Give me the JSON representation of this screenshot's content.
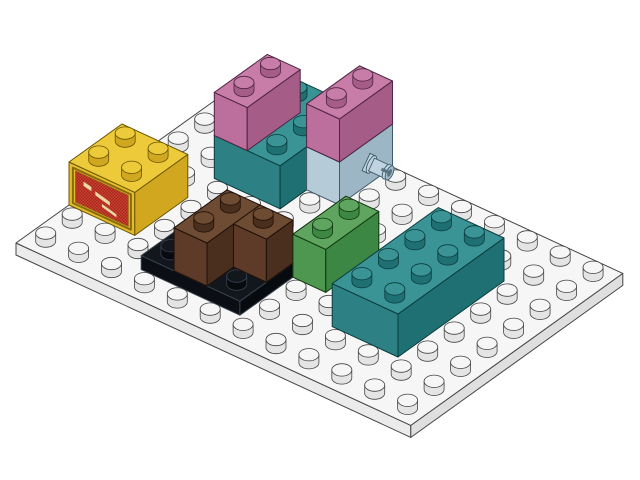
{
  "scene": {
    "type": "isometric-lego-render",
    "background": "#ffffff",
    "baseplate": {
      "name": "white-baseplate-12x8",
      "part": "plate 12 x 8",
      "cols": 12,
      "rows": 8,
      "colors": {
        "top": "#f6f6f6",
        "left": "#ebebeb",
        "right": "#dfdfdf",
        "stud_top": "#f6f6f6",
        "stud_side": "#e4e4e4",
        "edge": "#454545"
      }
    },
    "pieces": [
      {
        "name": "teal-brick-2x3-center",
        "part": "brick 2 x 3 teal",
        "color_name": "teal",
        "level": 0,
        "height": "brick",
        "boxes": [
          {
            "i": 2,
            "j": 5,
            "w": 2,
            "d": 3
          }
        ],
        "colors": {
          "top": "#3a9496",
          "left": "#2d8184",
          "right": "#1f7073",
          "edge": "#0b3b3c"
        }
      },
      {
        "name": "pink-brick-1x2-left",
        "part": "brick 1 x 2 dark pink",
        "color_name": "dark-pink",
        "level": 43,
        "height": "brick",
        "boxes": [
          {
            "i": 2,
            "j": 5,
            "w": 1,
            "d": 2
          }
        ],
        "colors": {
          "top": "#c87ca8",
          "left": "#bc6f9c",
          "right": "#a55d88",
          "edge": "#4e2440"
        }
      },
      {
        "name": "light-blue-brick-1x2-with-pin",
        "part": "brick 1 x 2 with technic pin",
        "color_name": "light-blue-gray",
        "level": 0,
        "height": "brick",
        "boxes": [
          {
            "i": 4,
            "j": 6,
            "w": 1,
            "d": 2
          }
        ],
        "colors": {
          "top": "#c4d6e0",
          "left": "#b5cbd7",
          "right": "#9cb6c5",
          "edge": "#3f5a68"
        },
        "pin": {
          "j_center": 7,
          "attach_height": 24,
          "length": 26,
          "colors": {
            "body": "#bfd4e0",
            "tip": "#a3bccb",
            "slot": "#5a7280",
            "edge": "#3f5a68"
          }
        }
      },
      {
        "name": "pink-brick-1x2-right",
        "part": "brick 1 x 2 dark pink",
        "color_name": "dark-pink",
        "level": 43,
        "height": "brick",
        "boxes": [
          {
            "i": 4,
            "j": 6,
            "w": 1,
            "d": 2
          }
        ],
        "colors": {
          "top": "#c87ca8",
          "left": "#bc6f9c",
          "right": "#a55d88",
          "edge": "#4e2440"
        }
      },
      {
        "name": "yellow-brick-2x2-decorated",
        "part": "brick 2 x 2 with red print",
        "color_name": "yellow",
        "level": 0,
        "height": "brick",
        "boxes": [
          {
            "i": 0,
            "j": 2,
            "w": 2,
            "d": 2
          }
        ],
        "colors": {
          "top": "#ecca3a",
          "left": "#e2bc2a",
          "right": "#d0a71e",
          "edge": "#6b5500"
        },
        "print": {
          "panel_color": "#a5251a",
          "dither_color": "#cf4a35",
          "accent_color": "#ecd7a8",
          "frame_color": "#8a6a10"
        }
      },
      {
        "name": "black-plate-3x2",
        "part": "plate 3 x 2 black",
        "color_name": "black",
        "level": 0,
        "height": "plate",
        "boxes": [
          {
            "i": 3,
            "j": 1,
            "w": 3,
            "d": 2
          }
        ],
        "colors": {
          "top": "#12171e",
          "left": "#0b0f15",
          "right": "#070b10",
          "edge": "#39424c"
        }
      },
      {
        "name": "brown-corner-brick-2x2",
        "part": "brick 2 x 2 corner brown",
        "color_name": "brown",
        "level": 14,
        "height": "brick",
        "boxes": [
          {
            "i": 4,
            "j": 1,
            "w": 1,
            "d": 2
          },
          {
            "i": 5,
            "j": 2,
            "w": 1,
            "d": 1
          }
        ],
        "colors": {
          "top": "#6e4c34",
          "left": "#5d3b28",
          "right": "#4a2e1e",
          "edge": "#1f1008"
        }
      },
      {
        "name": "green-brick-1x2",
        "part": "brick 1 x 2 green",
        "color_name": "green",
        "level": 0,
        "height": "brick",
        "boxes": [
          {
            "i": 6,
            "j": 3,
            "w": 1,
            "d": 2
          }
        ],
        "colors": {
          "top": "#5fa55f",
          "left": "#4d9750",
          "right": "#3b8743",
          "edge": "#10350f"
        }
      },
      {
        "name": "teal-brick-2x4-front",
        "part": "brick 2 x 4 teal",
        "color_name": "teal",
        "level": 0,
        "height": "brick",
        "boxes": [
          {
            "i": 8,
            "j": 2,
            "w": 2,
            "d": 4
          }
        ],
        "colors": {
          "top": "#3a9496",
          "left": "#2d8184",
          "right": "#1f7073",
          "edge": "#0b3b3c"
        }
      }
    ]
  }
}
